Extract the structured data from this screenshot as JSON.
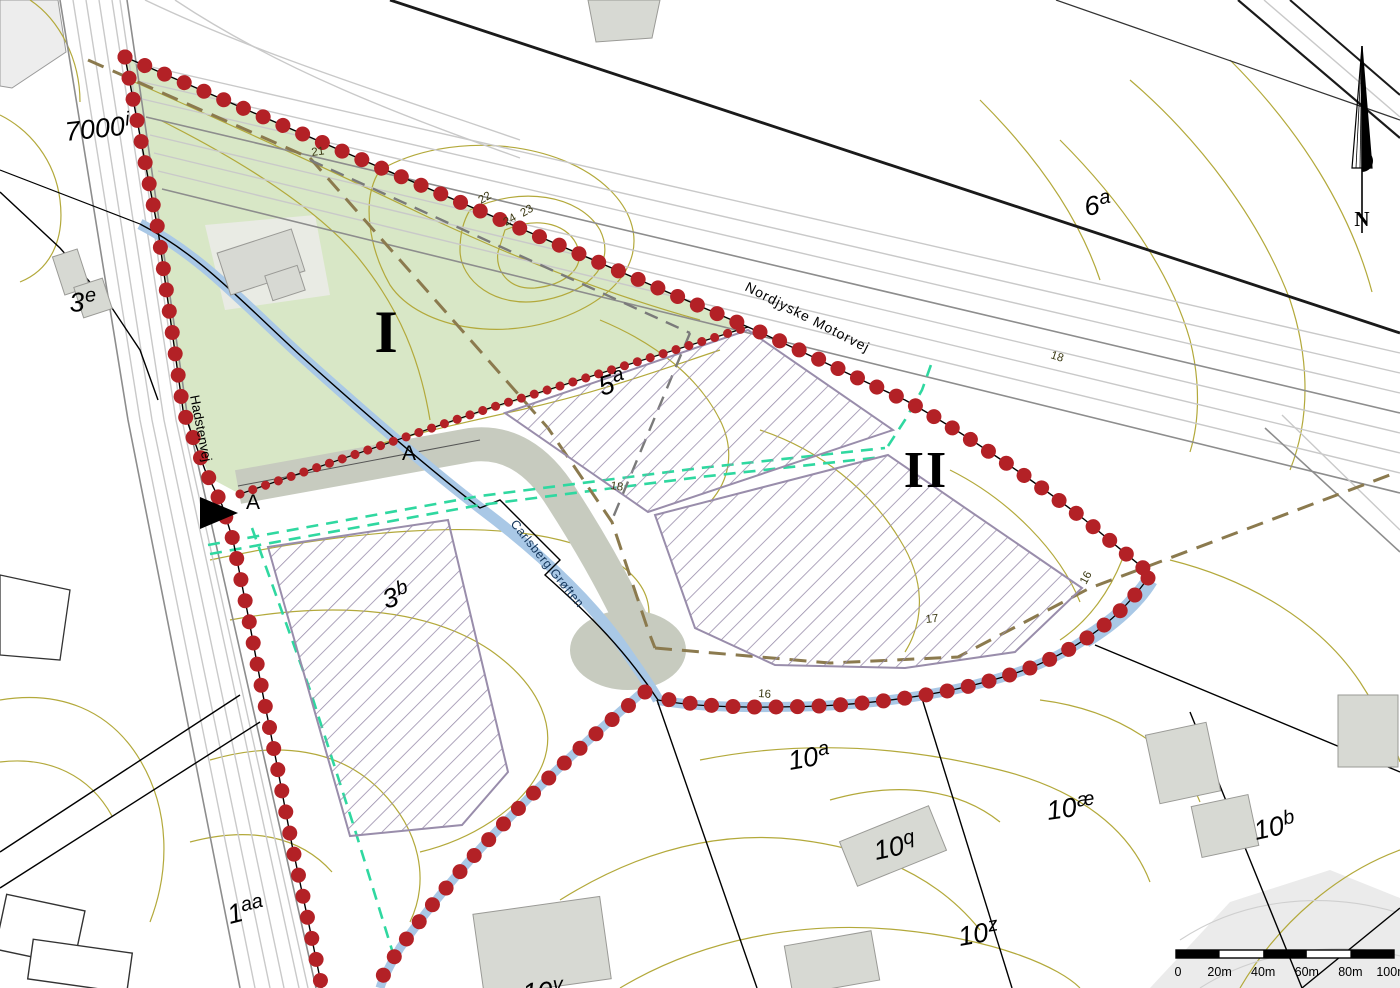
{
  "colors": {
    "site_green": "#d8e7c6",
    "boundary_dot_red": "#b32126",
    "hatch_purple": "#998dab",
    "contour_olive": "#b3a93b",
    "stream_blue": "#a9c8e6",
    "utility_teal": "#2fd8a0",
    "easement_brown": "#8b7a4e",
    "dashed_gray": "#7a7a7a"
  },
  "roads": {
    "motorway": "Nordjyske Motorvej",
    "local_road": "Hadstenvej",
    "stream": "Carlsberg Grøften"
  },
  "zones": {
    "zone1": "I",
    "zone2": "II",
    "section_marker_left": "A",
    "section_marker_right": "A"
  },
  "parcels": {
    "p7000i": {
      "base": "7000",
      "sup": "i"
    },
    "p3e": {
      "base": "3",
      "sup": "e"
    },
    "p5a": {
      "base": "5",
      "sup": "a"
    },
    "p6a": {
      "base": "6",
      "sup": "a"
    },
    "p3b": {
      "base": "3",
      "sup": "b"
    },
    "p10a": {
      "base": "10",
      "sup": "a"
    },
    "p10ae": {
      "base": "10",
      "sup": "æ"
    },
    "p10q": {
      "base": "10",
      "sup": "q"
    },
    "p10b": {
      "base": "10",
      "sup": "b"
    },
    "p10z": {
      "base": "10",
      "sup": "z"
    },
    "p1aa": {
      "base": "1",
      "sup": "aa"
    },
    "p10v": {
      "base": "10",
      "sup": "v"
    }
  },
  "contour_labels": {
    "c21": "21",
    "c22": "22",
    "c23": "23",
    "c24": "24",
    "c18_motorway": "18",
    "c18_mid": "18",
    "c16_east": "16",
    "c16_stream": "16",
    "c17": "17"
  },
  "north_arrow": {
    "label": "N"
  },
  "scale_bar": {
    "ticks": [
      "0",
      "20m",
      "40m",
      "60m",
      "80m",
      "100m"
    ]
  }
}
